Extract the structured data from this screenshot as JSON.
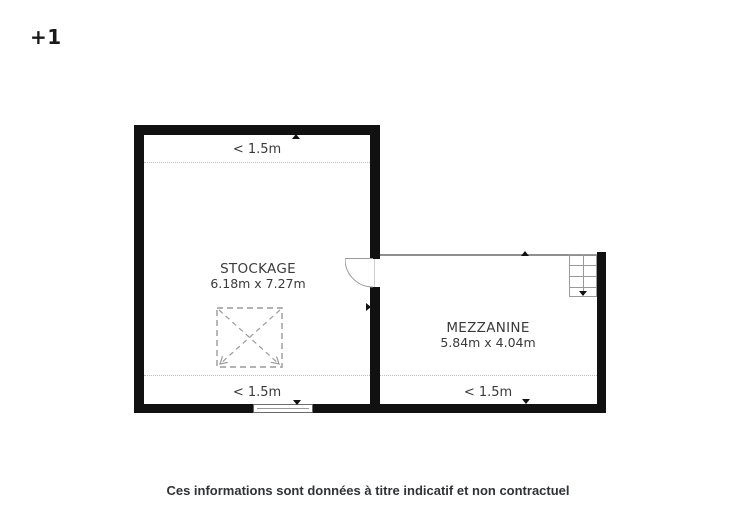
{
  "level_badge": "+1",
  "plan": {
    "stockage": {
      "name": "STOCKAGE",
      "size": "6.18m x 7.27m",
      "height_top": "< 1.5m",
      "height_bottom": "< 1.5m"
    },
    "mezzanine": {
      "name": "MEZZANINE",
      "size": "5.84m x 4.04m",
      "height_bottom": "< 1.5m"
    }
  },
  "footer": {
    "disclaimer": "Ces informations sont données à titre indicatif et non contractuel"
  },
  "colors": {
    "wall": "#111111",
    "thin_line": "#8f8f8f",
    "dashed_opening": "#9a9a9a",
    "dotted_zone_line": "#bdbdbd",
    "text": "#3a3a3a"
  }
}
